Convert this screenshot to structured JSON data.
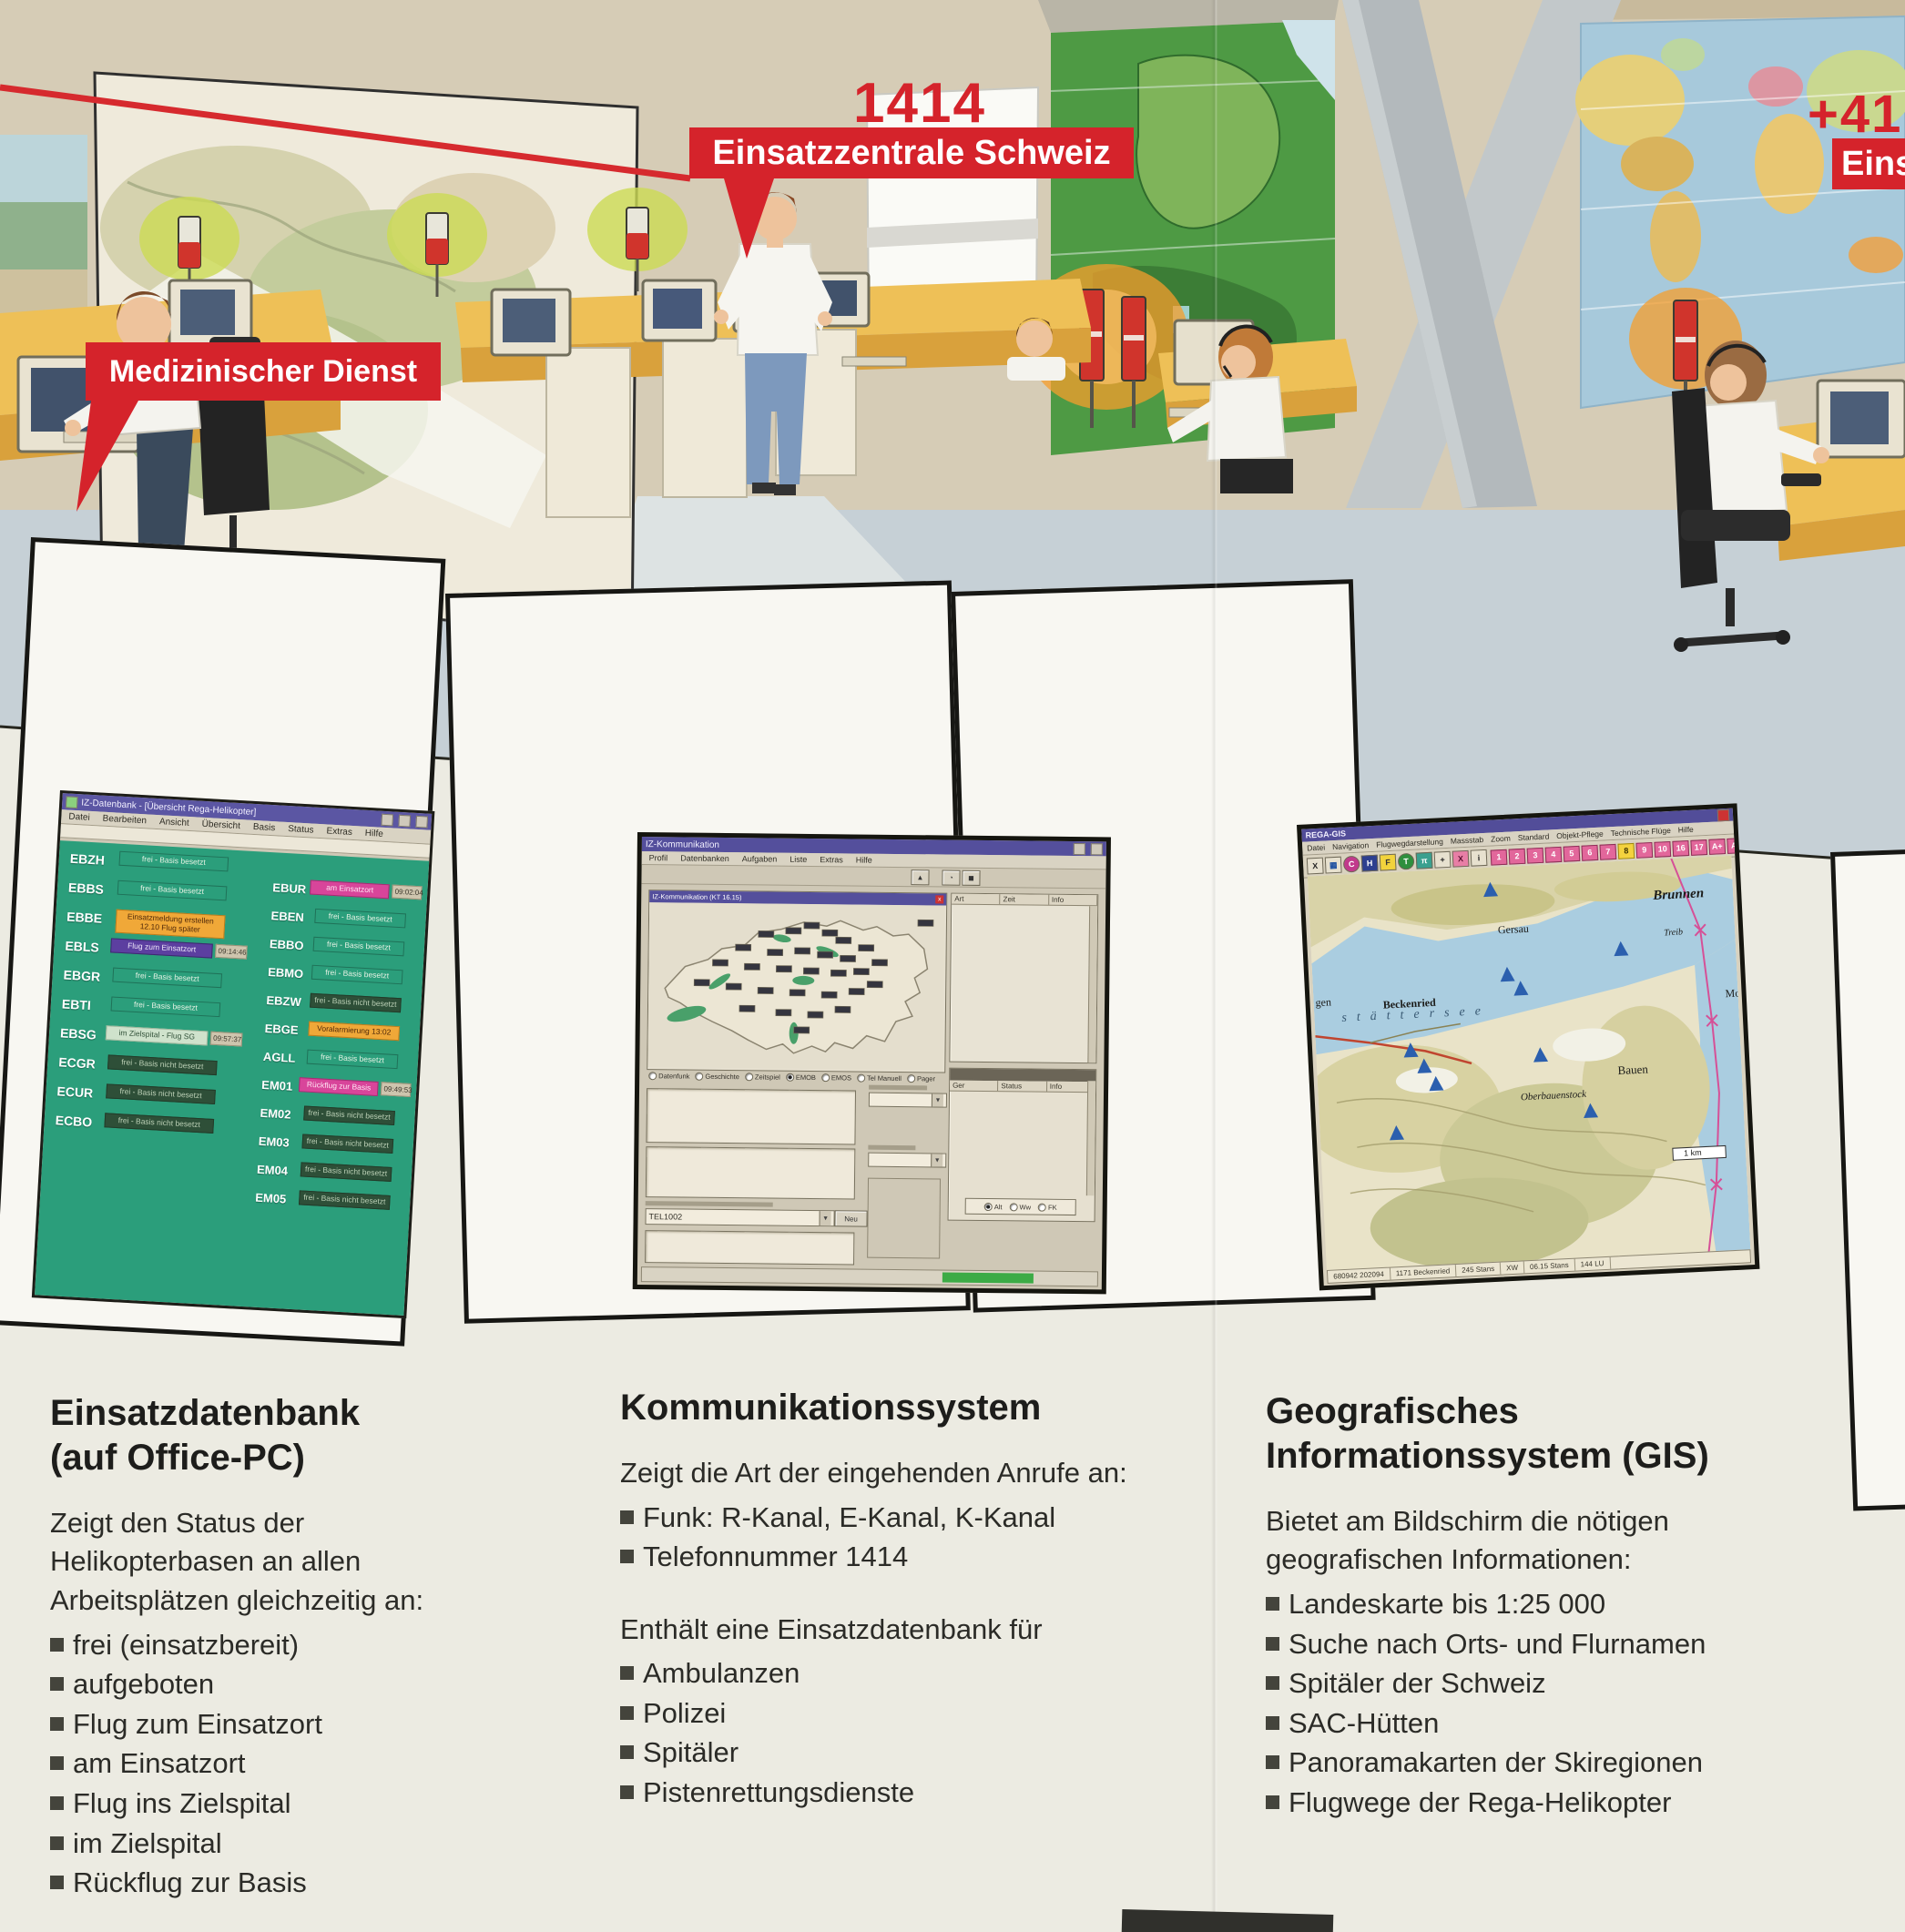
{
  "scene": {
    "callouts": {
      "medical": "Medizinischer Dienst",
      "number": "1414",
      "center": "Einsatzzentrale Schweiz",
      "intl_number": "+41",
      "intl_partial": "Eins"
    },
    "accent_red": "#d5232b"
  },
  "db": {
    "title": "IZ-Datenbank - [Übersicht Rega-Helikopter]",
    "menu_items": [
      "Datei",
      "Bearbeiten",
      "Ansicht",
      "Übersicht",
      "Basis",
      "Status",
      "Extras",
      "Hilfe"
    ],
    "left_rows": [
      {
        "code": "EBZH",
        "status": "frei - Basis besetzt",
        "type": "plain"
      },
      {
        "code": "EBBS",
        "status": "frei - Basis besetzt",
        "type": "plain"
      },
      {
        "code": "EBBE",
        "status": "Einsatzmeldung erstellen 12.10 Flug später",
        "type": "orange"
      },
      {
        "code": "EBLS",
        "status": "Flug zum Einsatzort",
        "time": "09:14:46",
        "type": "purple"
      },
      {
        "code": "EBGR",
        "status": "frei - Basis besetzt",
        "type": "plain"
      },
      {
        "code": "EBTI",
        "status": "frei - Basis besetzt",
        "type": "plain"
      },
      {
        "code": "EBSG",
        "status": "im Zielspital - Flug SG",
        "time": "09:57:37",
        "type": "light"
      },
      {
        "code": "ECGR",
        "status": "frei - Basis nicht besetzt",
        "type": "dark"
      },
      {
        "code": "ECUR",
        "status": "frei - Basis nicht besetzt",
        "type": "dark"
      },
      {
        "code": "ECBO",
        "status": "frei - Basis nicht besetzt",
        "type": "dark"
      }
    ],
    "right_rows": [
      {
        "code": "EBUR",
        "status": "am Einsatzort",
        "time": "09:02:04",
        "type": "magenta"
      },
      {
        "code": "EBEN",
        "status": "frei - Basis besetzt",
        "type": "plain"
      },
      {
        "code": "EBBO",
        "status": "frei - Basis besetzt",
        "type": "plain"
      },
      {
        "code": "EBMO",
        "status": "frei - Basis besetzt",
        "type": "plain"
      },
      {
        "code": "EBZW",
        "status": "frei - Basis nicht besetzt",
        "type": "dark"
      },
      {
        "code": "EBGE",
        "status": "Voralarmierung 13:02",
        "type": "orange"
      },
      {
        "code": "AGLL",
        "status": "frei - Basis besetzt",
        "type": "plain"
      },
      {
        "code": "EM01",
        "status": "Rückflug zur Basis",
        "time": "09:49:53",
        "type": "magenta"
      },
      {
        "code": "EM02",
        "status": "frei - Basis nicht besetzt",
        "type": "dark"
      },
      {
        "code": "EM03",
        "status": "frei - Basis nicht besetzt",
        "type": "dark"
      },
      {
        "code": "EM04",
        "status": "frei - Basis nicht besetzt",
        "type": "dark"
      },
      {
        "code": "EM05",
        "status": "frei - Basis nicht besetzt",
        "type": "dark"
      }
    ]
  },
  "comm": {
    "title": "IZ-Kommunikation",
    "menu_items": [
      "Profil",
      "Datenbanken",
      "Aufgaben",
      "Liste",
      "Extras",
      "Hilfe"
    ],
    "inner_title": "IZ-Kommunikation (KT 16.15)",
    "call_cols": [
      "Art",
      "Zeit",
      "Info"
    ],
    "radios": [
      {
        "t": "Datenfunk"
      },
      {
        "t": "Geschichte"
      },
      {
        "t": "Zeitspiel"
      },
      {
        "t": "EMOB",
        "on": true
      },
      {
        "t": "EMOS"
      },
      {
        "t": "Tel Manuell"
      },
      {
        "t": "Pager"
      }
    ],
    "phone_value": "TEL1002",
    "new_button": "Neu",
    "dev_cols": [
      "Ger",
      "Status",
      "Info"
    ],
    "modes": [
      {
        "t": "Alt",
        "on": true
      },
      {
        "t": "Ww"
      },
      {
        "t": "FK"
      }
    ]
  },
  "gis": {
    "title": "REGA-GIS",
    "menu_items": [
      "Datei",
      "Navigation",
      "Flugwegdarstellung",
      "Massstab",
      "Zoom",
      "Standard",
      "Objekt-Pflege",
      "Technische Flüge",
      "Hilfe"
    ],
    "tool_icons": [
      {
        "t": "X"
      },
      {
        "t": "▦",
        "type": "blu"
      },
      {
        "t": "C",
        "type": "mag"
      },
      {
        "t": "H",
        "type": "navy"
      },
      {
        "t": "F",
        "type": "yel"
      },
      {
        "t": "T",
        "type": "grn"
      },
      {
        "t": "π",
        "type": "teal"
      },
      {
        "t": "+"
      },
      {
        "t": "X",
        "type": "pink"
      },
      {
        "t": "i"
      }
    ],
    "tool_numbers": [
      {
        "t": "1"
      },
      {
        "t": "2"
      },
      {
        "t": "3"
      },
      {
        "t": "4"
      },
      {
        "t": "5"
      },
      {
        "t": "6"
      },
      {
        "t": "7"
      },
      {
        "t": "8",
        "type": "hl"
      },
      {
        "t": "9"
      },
      {
        "t": "10"
      },
      {
        "t": "16"
      },
      {
        "t": "17"
      },
      {
        "t": "A+"
      },
      {
        "t": "A-"
      }
    ],
    "labels": {
      "gen": "gen",
      "lake": "stättersee",
      "gersau": "Gersau",
      "brunnen": "Brunnen",
      "treib": "Treib",
      "beckenried": "Beckenried",
      "bauen": "Bauen",
      "oberbauenstock": "Oberbauenstock",
      "mo": "Mo",
      "scale": "1 km"
    },
    "status_items": [
      "680942 202094",
      "1171 Beckenried",
      "245 Stans",
      "XW",
      "06.15 Stans",
      "144 LU"
    ]
  },
  "articles": [
    {
      "title1": "Einsatzdatenbank",
      "title2": "(auf Office-PC)",
      "intro": "Zeigt den Status der Helikopterbasen an allen Arbeitsplätzen gleichzeitig an:",
      "bullets": [
        "frei (einsatzbereit)",
        "aufgeboten",
        "Flug zum Einsatzort",
        "am Einsatzort",
        "Flug ins Zielspital",
        "im Zielspital",
        "Rückflug zur Basis"
      ]
    },
    {
      "title1": "Kommunikationssystem",
      "intro": "Zeigt die Art der eingehenden Anrufe an:",
      "bullets": [
        "Funk: R-Kanal, E-Kanal, K-Kanal",
        "Telefonnummer 1414"
      ],
      "intro2": "Enthält eine Einsatzdatenbank für",
      "bullets2": [
        "Ambulanzen",
        "Polizei",
        "Spitäler",
        "Pistenrettungsdienste"
      ]
    },
    {
      "title1": "Geografisches",
      "title2": "Informationssystem (GIS)",
      "intro": "Bietet am Bildschirm die nötigen geografischen Informationen:",
      "bullets": [
        "Landeskarte bis 1:25 000",
        "Suche nach Orts- und Flurnamen",
        "Spitäler der Schweiz",
        "SAC-Hütten",
        "Panoramakarten der Skiregionen",
        "Flugwege der Rega-Helikopter"
      ]
    }
  ]
}
